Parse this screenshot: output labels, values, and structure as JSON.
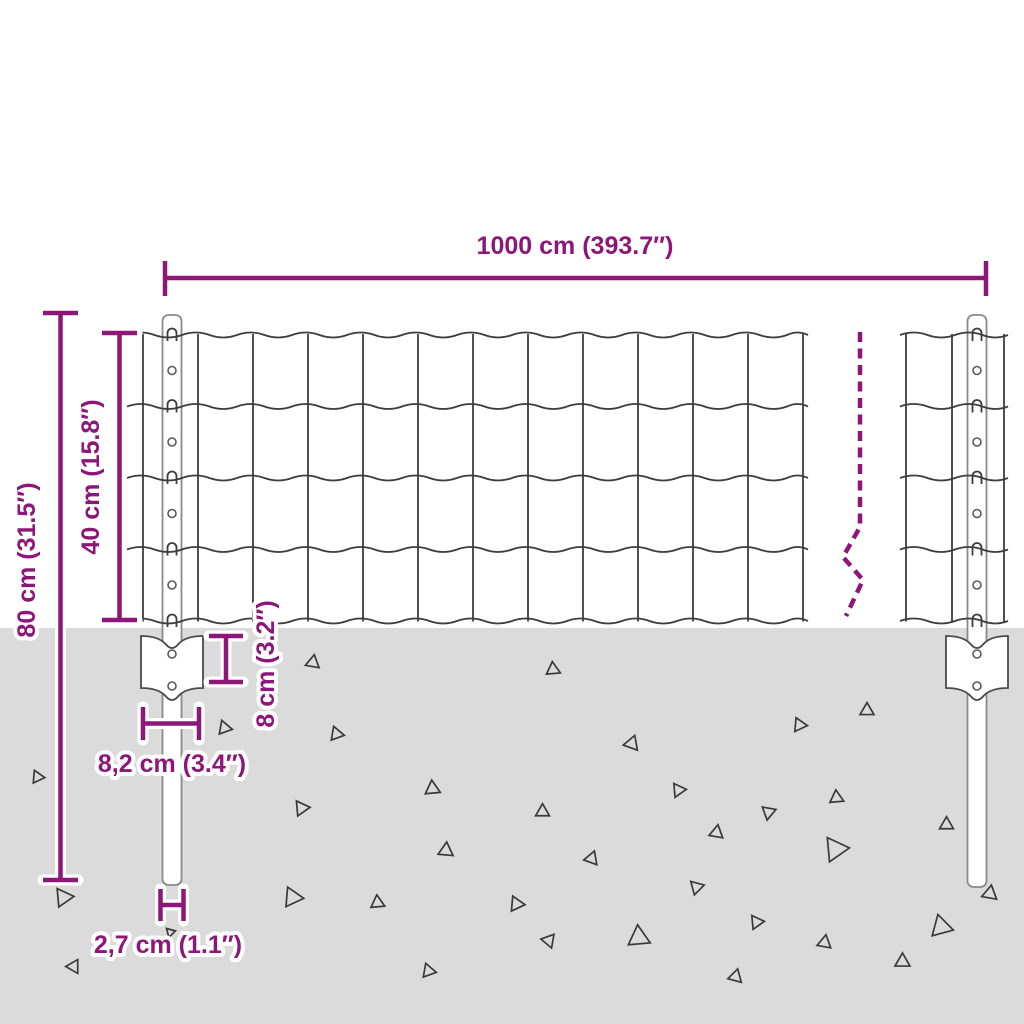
{
  "diagram": {
    "type": "product-dimension-diagram",
    "subject": "wire mesh fence with posts and anchor plates partially buried in ground",
    "dimensions": {
      "total_width_label": "1000 cm (393.7″)",
      "post_height_label": "80 cm (31.5″)",
      "mesh_height_label": "40 cm (15.8″)",
      "anchor_plate_depth_label": "8 cm (3.2″)",
      "anchor_plate_width_label": "8,2 cm (3.4″)",
      "post_diameter_label": "2,7 cm (1.1″)"
    },
    "colors": {
      "accent": "#8D1679",
      "ground": "#DBDBDB",
      "wire": "#3D3D3D",
      "post_outline": "#8A8A8A",
      "background": "#FFFFFF"
    }
  }
}
